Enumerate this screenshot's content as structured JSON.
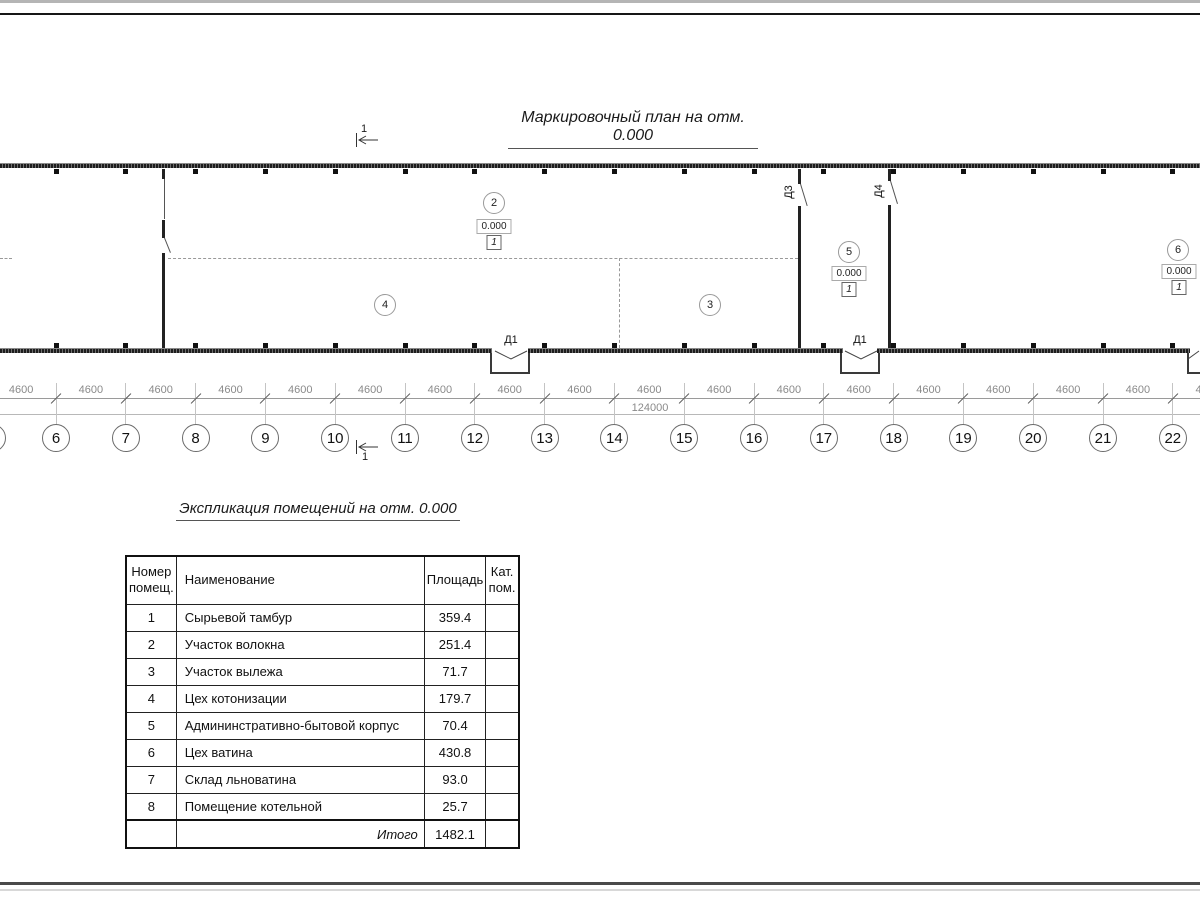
{
  "plan": {
    "title": "Маркировочный план на отм. 0.000",
    "section_label": "1",
    "grid_numbers": [
      "6",
      "7",
      "8",
      "9",
      "10",
      "11",
      "12",
      "13",
      "14",
      "15",
      "16",
      "17",
      "18",
      "19",
      "20",
      "21",
      "22"
    ],
    "bay_dim": "4600",
    "total_dim": "124000",
    "doors": {
      "d1": "Д1",
      "d3": "Д3",
      "d4": "Д4"
    },
    "rooms": {
      "r2": {
        "number": "2",
        "elevation": "0.000",
        "floor_type": "1"
      },
      "r3": {
        "number": "3"
      },
      "r4": {
        "number": "4"
      },
      "r5": {
        "number": "5",
        "elevation": "0.000",
        "floor_type": "1"
      },
      "r6": {
        "number": "6",
        "elevation": "0.000",
        "floor_type": "1"
      }
    }
  },
  "table": {
    "title": "Экспликация помещений на отм. 0.000",
    "headers": {
      "num": "Номер помещ.",
      "name": "Наименование",
      "area": "Площадь",
      "cat": "Кат. пом."
    },
    "rows": [
      {
        "num": "1",
        "name": "Сырьевой тамбур",
        "area": "359.4",
        "cat": ""
      },
      {
        "num": "2",
        "name": "Участок волокна",
        "area": "251.4",
        "cat": ""
      },
      {
        "num": "3",
        "name": "Участок вылежа",
        "area": "71.7",
        "cat": ""
      },
      {
        "num": "4",
        "name": "Цех котонизации",
        "area": "179.7",
        "cat": ""
      },
      {
        "num": "5",
        "name": "Админинстративно-бытовой корпус",
        "area": "70.4",
        "cat": ""
      },
      {
        "num": "6",
        "name": "Цех ватина",
        "area": "430.8",
        "cat": ""
      },
      {
        "num": "7",
        "name": "Склад льноватина",
        "area": "93.0",
        "cat": ""
      },
      {
        "num": "8",
        "name": "Помещение котельной",
        "area": "25.7",
        "cat": ""
      }
    ],
    "total_label": "Итого",
    "total_value": "1482.1"
  }
}
